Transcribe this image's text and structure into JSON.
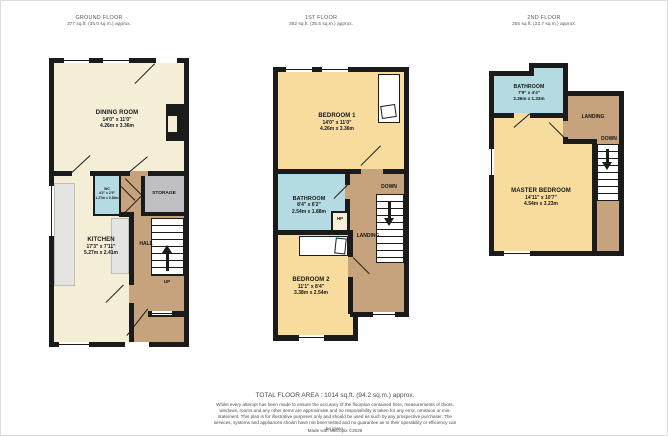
{
  "palette": {
    "wall": "#1b1b1b",
    "cream_room": "#f5eed7",
    "yellow_room": "#f7dc9e",
    "blue_room": "#b4dbe2",
    "tan_hall": "#c6a37c",
    "storage_gray": "#bfbfc4",
    "counter_gray": "#e4e4e2"
  },
  "floors": [
    {
      "title": "GROUND FLOOR",
      "area": "377 sq.ft. (35.0 sq.m.) approx.",
      "rooms": {
        "dining": {
          "name": "DINING ROOM",
          "imperial": "14'0\" x 11'0\"",
          "metric": "4.26m x 3.36m"
        },
        "kitchen": {
          "name": "KITCHEN",
          "imperial": "17'3\" x 7'11\"",
          "metric": "5.27m x 2.41m"
        },
        "wc": {
          "name": "WC",
          "imperial": "4'2\" x 2'9\"",
          "metric": "1.27m x 0.84m"
        },
        "storage": {
          "name": "STORAGE"
        },
        "hall": {
          "name": "HALL"
        },
        "stairs": {
          "label": "UP"
        }
      }
    },
    {
      "title": "1ST FLOOR",
      "area": "382 sq.ft. (35.5 sq.m.) approx.",
      "rooms": {
        "bedroom1": {
          "name": "BEDROOM 1",
          "imperial": "14'0\" x 11'0\"",
          "metric": "4.26m x 3.36m"
        },
        "bathroom": {
          "name": "BATHROOM",
          "imperial": "8'4\" x 6'2\"",
          "metric": "2.54m x 1.88m"
        },
        "hp": {
          "name": "HP"
        },
        "landing": {
          "name": "LANDING"
        },
        "bedroom2": {
          "name": "BEDROOM 2",
          "imperial": "11'1\" x 8'4\"",
          "metric": "3.38m x 2.54m"
        },
        "stairs": {
          "label": "DOWN"
        }
      }
    },
    {
      "title": "2ND FLOOR",
      "area": "255 sq.ft. (23.7 sq.m.) approx.",
      "rooms": {
        "bathroom": {
          "name": "BATHROOM",
          "imperial": "7'9\" x 4'4\"",
          "metric": "2.36m x 1.33m"
        },
        "landing": {
          "name": "LANDING"
        },
        "master": {
          "name": "MASTER BEDROOM",
          "imperial": "14'11\" x 10'7\"",
          "metric": "4.54m x 3.23m"
        },
        "stairs": {
          "label": "DOWN"
        }
      }
    }
  ],
  "footer": {
    "total": "TOTAL FLOOR AREA : 1014 sq.ft. (94.2 sq.m.) approx.",
    "disclaimer": "Whilst every attempt has been made to ensure the accuracy of the floorplan contained here, measurements of doors, windows, rooms and any other items are approximate and no responsibility is taken for any error, omission or mis-statement. This plan is for illustrative purposes only and should be used as such by any prospective purchaser. The services, systems and appliances shown have not been tested and no guarantee as to their operability or efficiency can be given.",
    "credit": "Made with Metropix ©2026"
  }
}
